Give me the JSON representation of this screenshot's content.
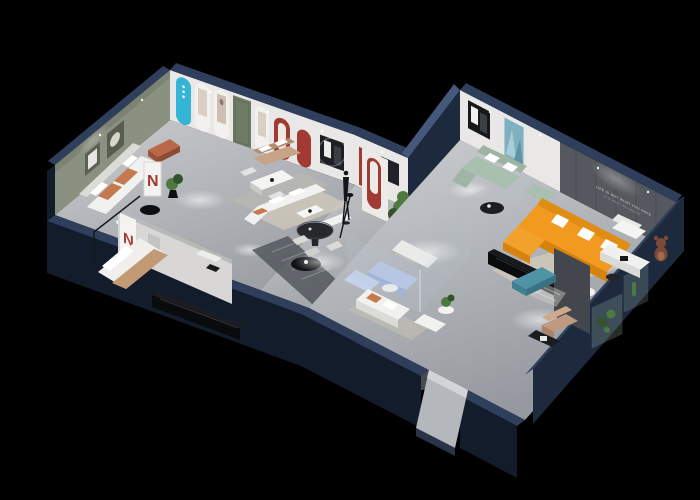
{
  "meta": {
    "title": "3D isometric cutaway render of a furniture showroom floor plan on a black background"
  },
  "palette": {
    "bg": "#000000",
    "wall_outer_dark": "#131c2a",
    "wall_outer_mid": "#1d2a3e",
    "wall_top_band": "#2f3e5a",
    "wall_top_band_light": "#45577a",
    "wall_inner_white": "#e9e8e6",
    "wall_inner_shade": "#d6d5d4",
    "olive_wall": "#8b9181",
    "feature_wall": "#55585e",
    "floor_light": "#c7c9cc",
    "floor_mid": "#aaadb2",
    "walkway_dark": "#54585e",
    "rug_beige": "#cfc8ba",
    "glass_tint": "#b9cdd8",
    "sofa_white": "#f1f1ef",
    "pillow_white": "#ffffff",
    "cushion_orange": "#c5794e",
    "sofa_tan": "#c7a387",
    "sofa_sage": "#a9bfb0",
    "sofa_orange": "#f29a1f",
    "sofa_orange_deep": "#d8820e",
    "sofa_blue": "#b7c6e6",
    "teal_accent": "#35b5d6",
    "teal_bench": "#4f93a5",
    "red_accent": "#a03a32",
    "green_door": "#6e7c66",
    "plant_green": "#4e7a42",
    "plant_dark": "#33532c",
    "black_furniture": "#0e0f12",
    "art_teal": "#7fb0bf",
    "bear_brown": "#7b4a36"
  },
  "left_wing": {
    "display_panel_glyph": "N",
    "partition_panel_glyph": "N"
  },
  "right_wing": {
    "wall_slogan_line1": "LIFE IS NOT WHAT YOU HAVE",
    "wall_slogan_line2": "IT IS WHAT YOU CREATE"
  }
}
